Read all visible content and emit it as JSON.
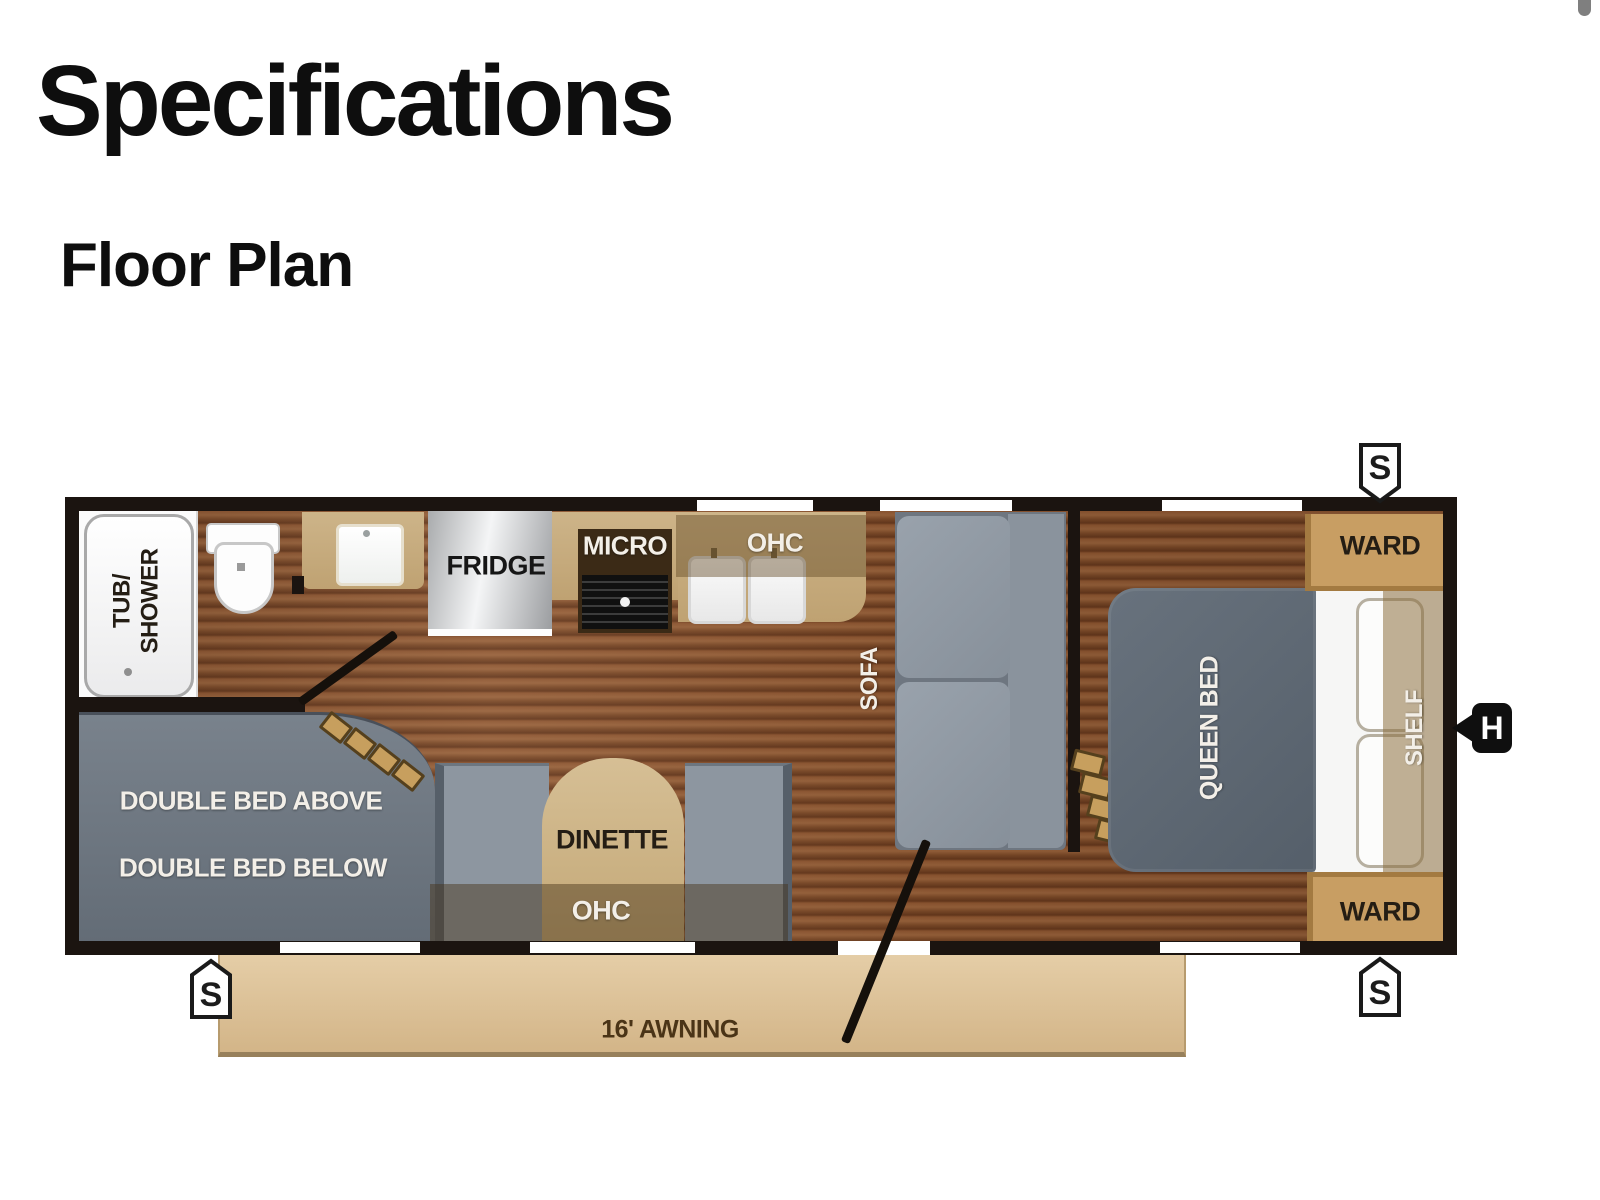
{
  "header": {
    "title": "Specifications",
    "subtitle": "Floor Plan"
  },
  "plan": {
    "labels": {
      "tub_line1": "TUB/",
      "tub_line2": "SHOWER",
      "fridge": "FRIDGE",
      "micro": "MICRO",
      "kitchen_ohc": "OHC",
      "sofa": "SOFA",
      "queen_bed": "QUEEN BED",
      "shelf": "SHELF",
      "ward_top": "WARD",
      "ward_bottom": "WARD",
      "bunk_above": "DOUBLE BED ABOVE",
      "bunk_below": "DOUBLE BED BELOW",
      "dinette": "DINETTE",
      "dinette_ohc": "OHC",
      "awning": "16' AWNING"
    },
    "markers": {
      "s_top": "S",
      "s_bottom_left": "S",
      "s_bottom_right": "S",
      "h_right": "H"
    },
    "colors": {
      "wall": "#1b1410",
      "wood": "#7e4b27",
      "counter_tan": "#c7ab7c",
      "ward_tan": "#c89e63",
      "furniture_gray": "#8d96a0",
      "bed_gray": "#5d6771",
      "bunk_gray": "#6b747e",
      "awning_tan": "#e0c69e"
    }
  }
}
